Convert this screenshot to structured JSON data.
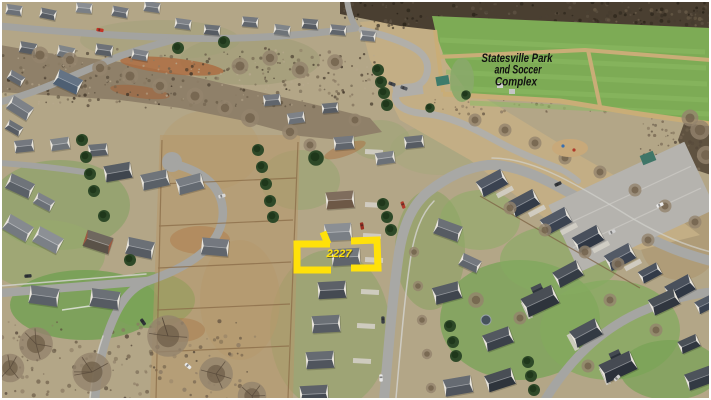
{
  "annotations": {
    "park_label": {
      "lines": [
        "Statesville Park",
        "and Soccer",
        "Complex"
      ],
      "color": "#101010"
    },
    "property_highlight": {
      "label": "2227",
      "color": "#ffe10a"
    }
  },
  "palette": {
    "frame_white": "#ffffff",
    "field_green": "#7dab55",
    "field_stripe": "#8cbb63",
    "road_gray": "#a5a5a2",
    "ground_tan": "#b3a687",
    "woods_brown": "#8f8069",
    "lawn_green": "#7aa459",
    "roof_dark": "#3a4250"
  }
}
